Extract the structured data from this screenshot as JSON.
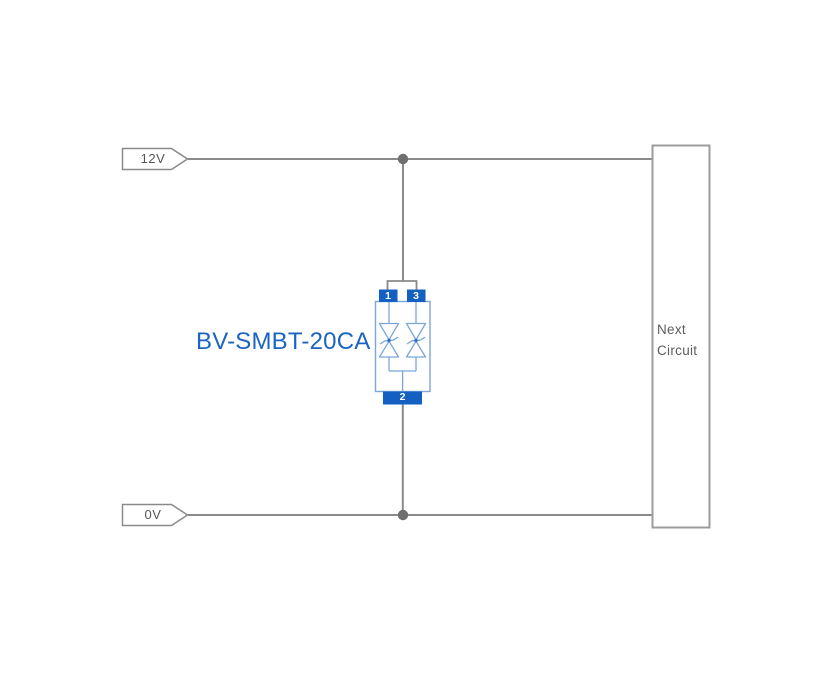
{
  "canvas": {
    "background": "#ffffff"
  },
  "power_rails": {
    "top": {
      "label": "12V"
    },
    "bottom": {
      "label": "0V"
    }
  },
  "component": {
    "label": "BV-SMBT-20CA",
    "pins": {
      "top_left": "1",
      "top_right": "3",
      "bottom": "2"
    }
  },
  "next_circuit": {
    "label": "Next Circuit"
  },
  "colors": {
    "wire": "#8a8a8a",
    "junction_dot": "#6f6f6f",
    "net_label_border": "#8a8a8a",
    "net_label_text": "#575757",
    "next_circuit_border": "#9c9c9c",
    "next_circuit_text": "#5c5c5c",
    "component_pin_fill": "#1460c2",
    "component_pin_text": "#ffffff",
    "component_outline": "#7ca6d8",
    "component_center_dot": "#2f6fc6",
    "component_label_text": "#1b64c1"
  }
}
